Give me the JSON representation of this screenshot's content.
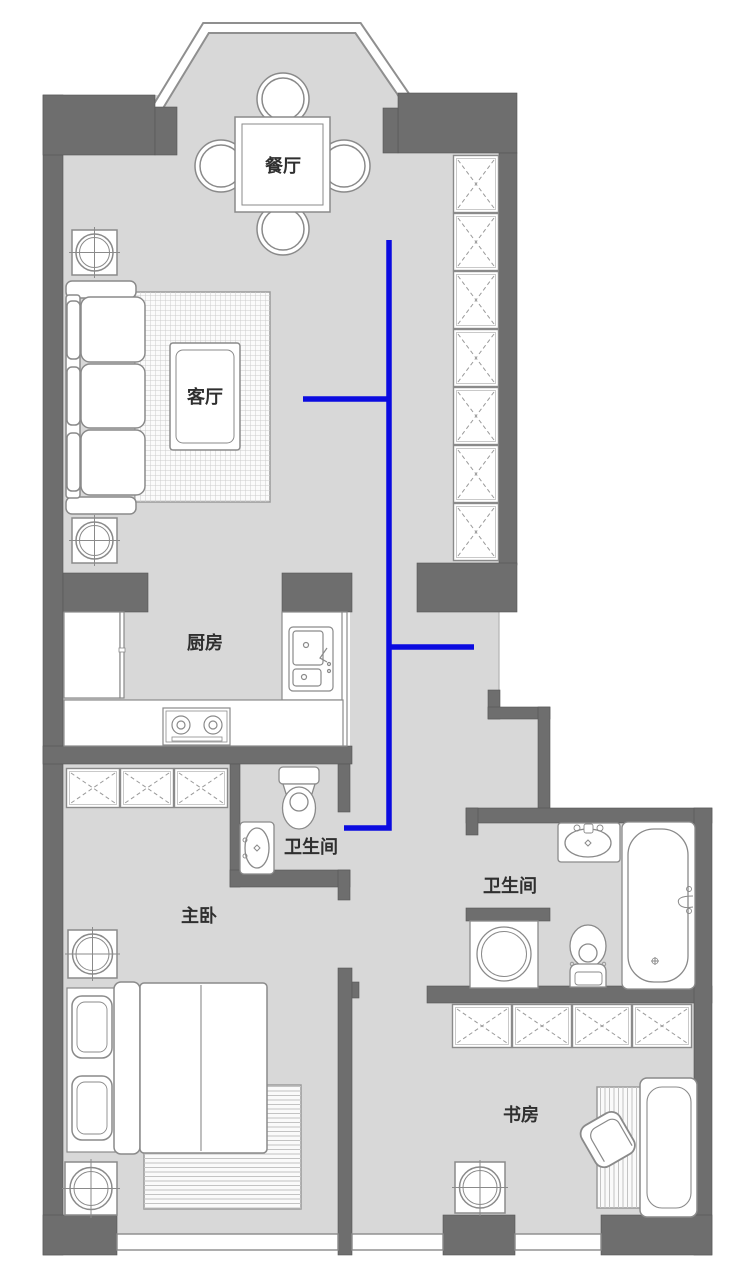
{
  "plan": {
    "type": "apartment-floor-plan",
    "rooms": [
      {
        "name": "dining-room",
        "label": "餐厅"
      },
      {
        "name": "living-room",
        "label": "客厅"
      },
      {
        "name": "kitchen",
        "label": "厨房"
      },
      {
        "name": "bathroom-inner",
        "label": "卫生间"
      },
      {
        "name": "bathroom-main",
        "label": "卫生间"
      },
      {
        "name": "master-bedroom",
        "label": "主卧"
      },
      {
        "name": "study",
        "label": "书房"
      }
    ],
    "colors": {
      "wall": "#6e6e6e",
      "floor": "#d8d8d8",
      "route_line": "#0b0be0",
      "furniture_outline": "#8a8a8a",
      "label_text": "#2f2f2f"
    }
  }
}
